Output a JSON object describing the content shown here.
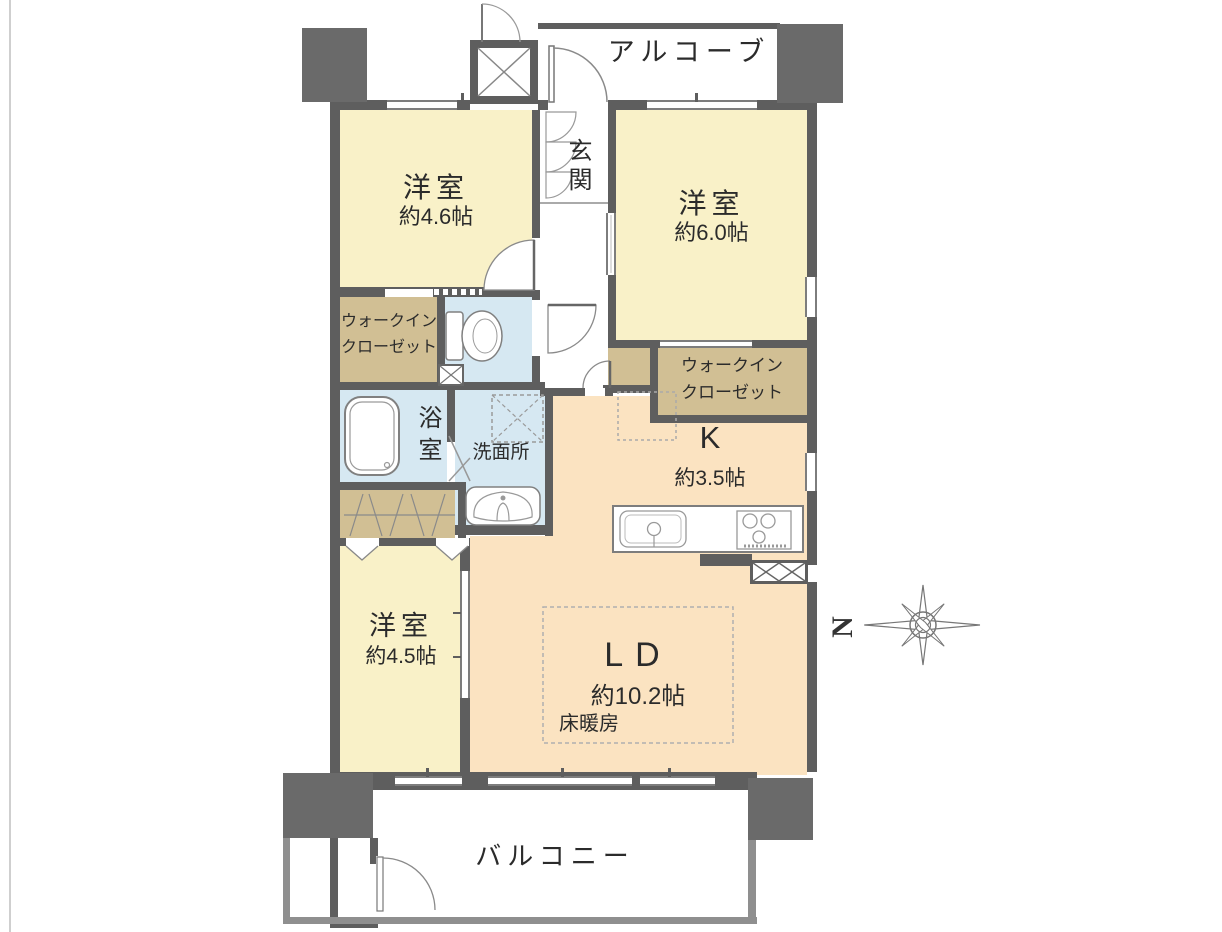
{
  "title": "マンション間取り図",
  "rooms": {
    "alcove": {
      "label": "アルコーブ"
    },
    "entrance": {
      "label": "玄関"
    },
    "room_46": {
      "label": "洋室",
      "size": "約4.6帖"
    },
    "room_60": {
      "label": "洋室",
      "size": "約6.0帖"
    },
    "wic_left": {
      "line1": "ウォークイン",
      "line2": "クローゼット"
    },
    "wic_right": {
      "line1": "ウォークイン",
      "line2": "クローゼット"
    },
    "bathroom": {
      "label": "浴室"
    },
    "washroom": {
      "label": "洗面所"
    },
    "kitchen": {
      "label": "K",
      "size": "約3.5帖"
    },
    "living_dining": {
      "label": "LD",
      "size": "約10.2帖",
      "floor_heating": "床暖房"
    },
    "room_45": {
      "label": "洋室",
      "size": "約4.5帖"
    },
    "balcony": {
      "label": "バルコニー"
    }
  },
  "compass": {
    "label": "N"
  },
  "colors": {
    "wall": "#5e5e5e",
    "pillar": "#6a6a6a",
    "western_room": "#f9f1c8",
    "ldk": "#fbe3c1",
    "closet": "#d1bf94",
    "wet_area": "#d6e8f2",
    "line": "#8a8a8a"
  }
}
